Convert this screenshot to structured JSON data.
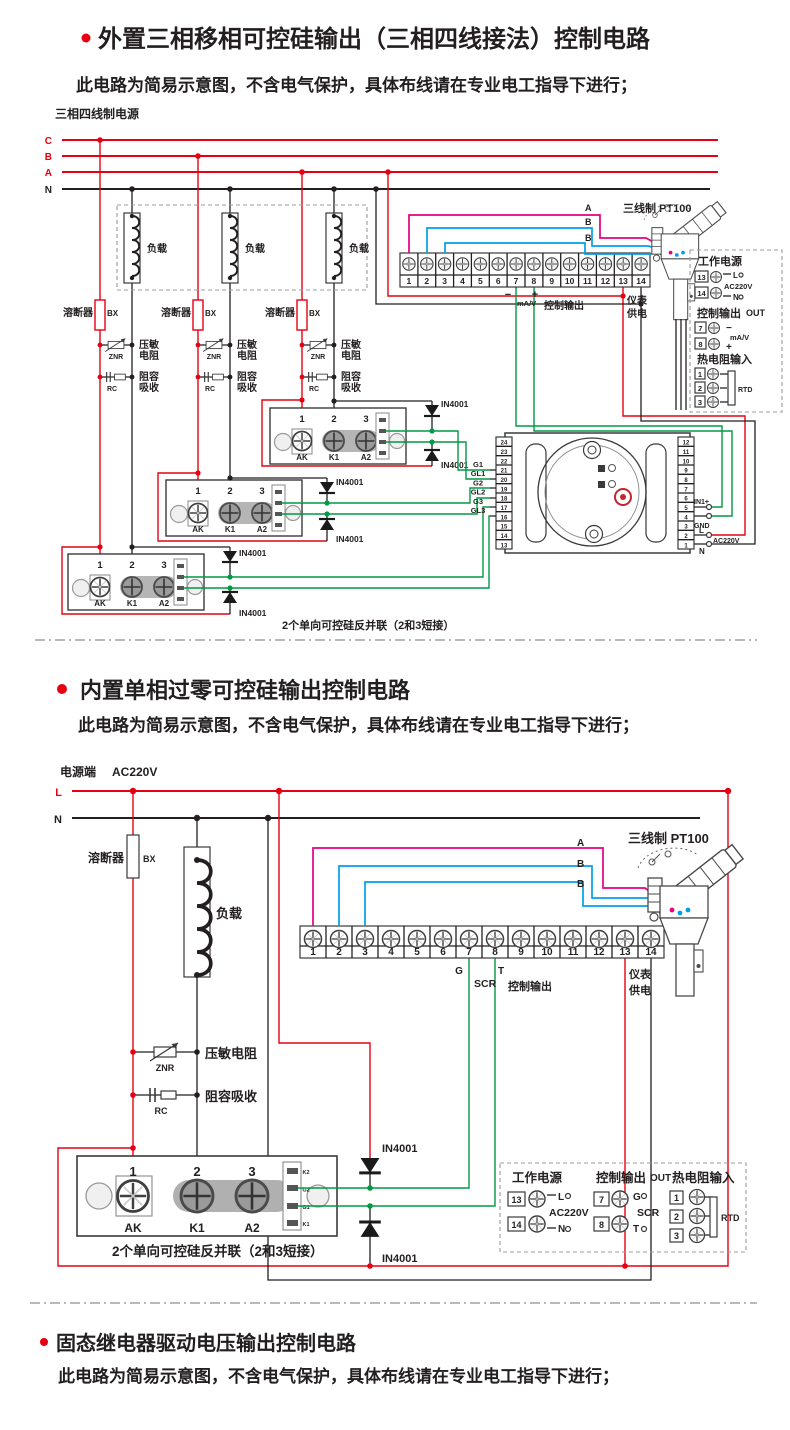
{
  "s1": {
    "title": "外置三相移相可控硅输出（三相四线接法）控制电路",
    "subtitle": "此电路为简易示意图，不含电气保护，具体布线请在专业电工指导下进行；",
    "power_label": "三相四线制电源",
    "phase_c": "C",
    "phase_b": "B",
    "phase_a": "A",
    "phase_n": "N",
    "load": "负载",
    "fuse": "溶断器",
    "fuse_code": "BX",
    "znr_1": "压敏",
    "znr_2": "电阻",
    "znr_code": "ZNR",
    "rc_1": "阻容",
    "rc_2": "吸收",
    "rc_code": "RC",
    "mod_nums": [
      "1",
      "2",
      "3"
    ],
    "mod_terms": [
      "AK",
      "K1",
      "A2"
    ],
    "diode": "IN4001",
    "caption": "2个单向可控硅反并联（2和3短接）",
    "strip_numbers": [
      "1",
      "2",
      "3",
      "4",
      "5",
      "6",
      "7",
      "8",
      "9",
      "10",
      "11",
      "12",
      "13",
      "14"
    ],
    "out_minus": "−",
    "out_mav": "mA/V",
    "out_plus": "+",
    "out_label": "控制输出",
    "meter_1": "仪表",
    "meter_2": "供电",
    "pt100_title": "三线制  PT100",
    "wire_a": "A",
    "wire_b1": "B",
    "wire_b2": "B",
    "gate_labels": [
      "G1",
      "GL1",
      "G2",
      "GL2",
      "G3",
      "GL3"
    ],
    "ctrl_left": [
      "24",
      "23",
      "22",
      "21",
      "20",
      "19",
      "18",
      "17",
      "16",
      "15",
      "14",
      "13"
    ],
    "ctrl_right": [
      "12",
      "11",
      "10",
      "9",
      "8",
      "7",
      "6",
      "5",
      "4",
      "3",
      "2",
      "1"
    ],
    "in1": "IN1+",
    "gnd": "GND",
    "lbl_l": "L",
    "lbl_ac": "AC220V",
    "lbl_n": "N",
    "panel": {
      "power": "工作电源",
      "n13": "13",
      "n14": "14",
      "l": "L",
      "ac": "AC220V",
      "n": "N",
      "out": "控制输出",
      "out_en": "OUT",
      "n7": "7",
      "n8": "8",
      "minus": "−",
      "mav": "mA/V",
      "plus": "+",
      "rtd_title": "热电阻输入",
      "n1": "1",
      "n2": "2",
      "n3": "3",
      "rtd": "RTD"
    }
  },
  "s2": {
    "title": "内置单相过零可控硅输出控制电路",
    "subtitle": "此电路为简易示意图，不含电气保护，具体布线请在专业电工指导下进行；",
    "power_label": "电源端",
    "power_ac": "AC220V",
    "lbl_l": "L",
    "lbl_n": "N",
    "fuse": "溶断器",
    "fuse_code": "BX",
    "load": "负载",
    "znr": "压敏电阻",
    "znr_code": "ZNR",
    "rc": "阻容吸收",
    "rc_code": "RC",
    "mod_nums": [
      "1",
      "2",
      "3"
    ],
    "mod_terms": [
      "AK",
      "K1",
      "A2"
    ],
    "gate_labels": [
      "K2",
      "G2",
      "G1",
      "K1"
    ],
    "diode": "IN4001",
    "caption": "2个单向可控硅反并联（2和3短接）",
    "strip_numbers": [
      "1",
      "2",
      "3",
      "4",
      "5",
      "6",
      "7",
      "8",
      "9",
      "10",
      "11",
      "12",
      "13",
      "14"
    ],
    "lbl_g": "G",
    "lbl_scr": "SCR",
    "lbl_t": "T",
    "out_label": "控制输出",
    "meter_1": "仪表",
    "meter_2": "供电",
    "pt100_title": "三线制  PT100",
    "wire_a": "A",
    "wire_b1": "B",
    "wire_b2": "B",
    "panel": {
      "power": "工作电源",
      "n13": "13",
      "n14": "14",
      "l": "L",
      "ac": "AC220V",
      "n": "N",
      "out": "控制输出",
      "out_en": "OUT",
      "n7": "7",
      "n8": "8",
      "g": "G",
      "scr": "SCR",
      "t": "T",
      "rtd_title": "热电阻输入",
      "n1": "1",
      "n2": "2",
      "n3": "3",
      "rtd": "RTD"
    }
  },
  "s3": {
    "title": "固态继电器驱动电压输出控制电路",
    "subtitle": "此电路为简易示意图，不含电气保护，具体布线请在专业电工指导下进行；"
  }
}
